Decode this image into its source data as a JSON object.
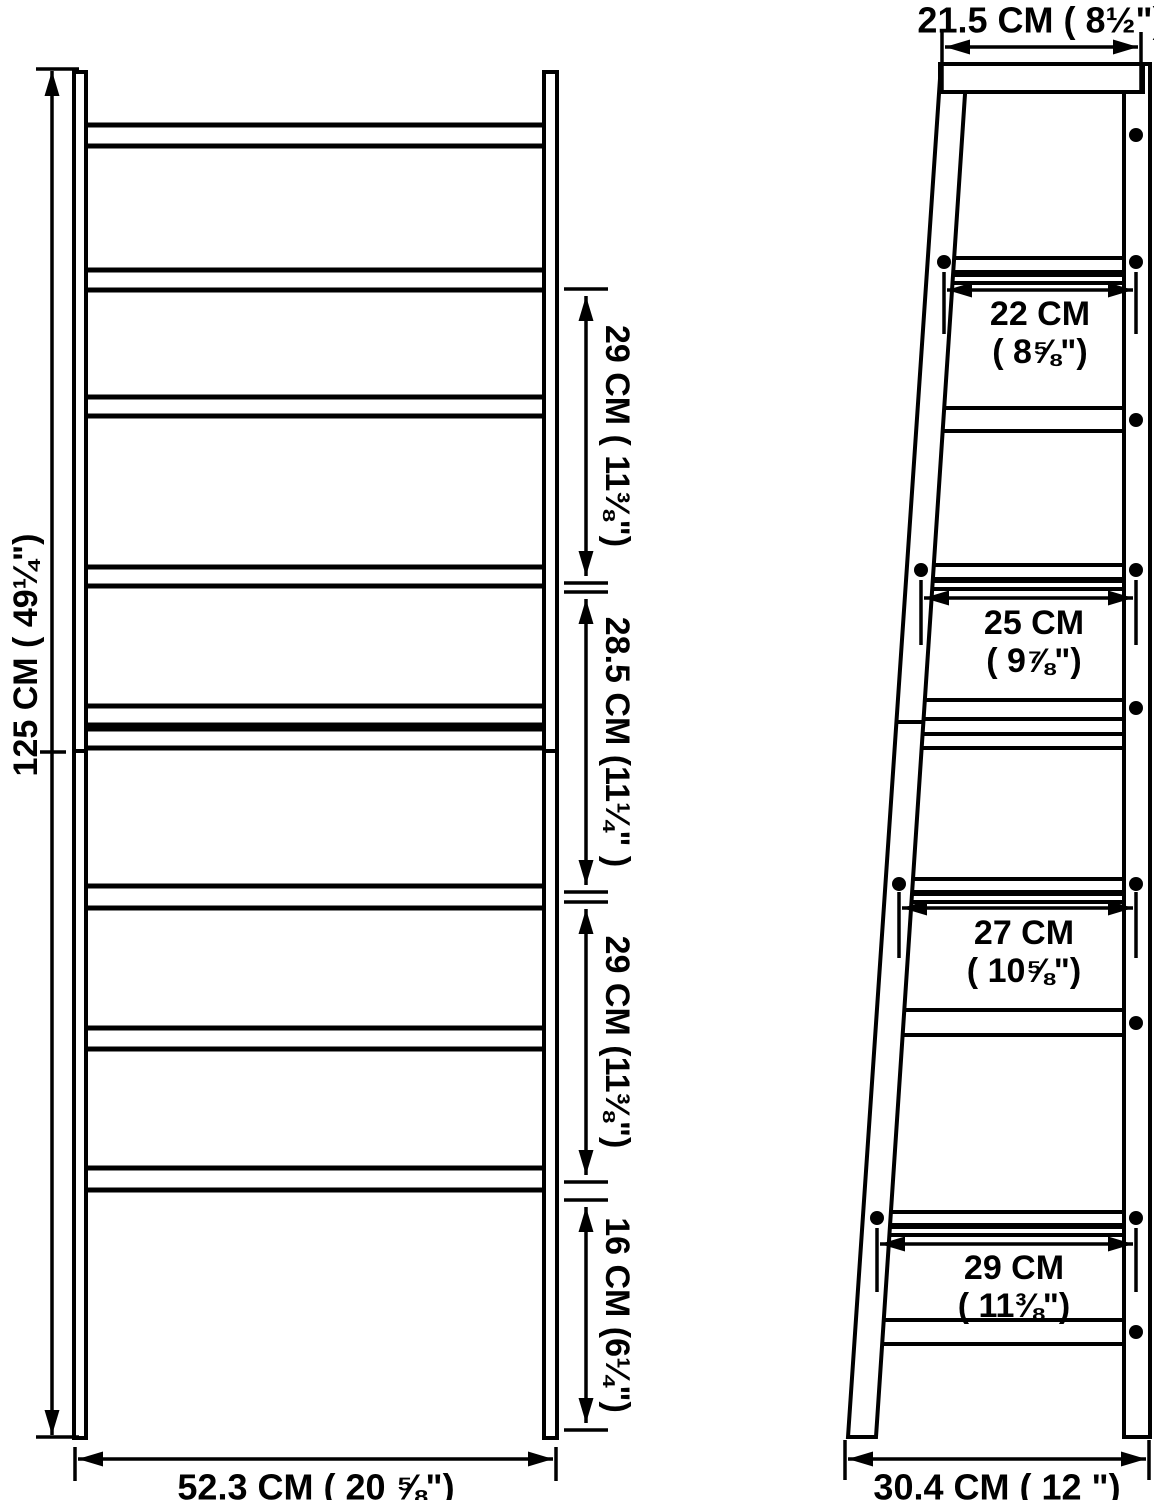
{
  "front_view": {
    "height_label": "125 CM ( 49¼\")",
    "width_label": "52.3 CM ( 20 ⅝\")",
    "tier_gaps": [
      {
        "label": "29 CM ( 11⅜\")"
      },
      {
        "label": "28.5 CM (11¼\" )"
      },
      {
        "label": "29 CM (11⅜\")"
      },
      {
        "label": "16 CM (6¼\")"
      }
    ]
  },
  "side_view": {
    "top_depth_label": "21.5 CM ( 8½\")",
    "base_depth_label": "30.4 CM ( 12 \")",
    "shelf_depths": [
      {
        "cm": "22 CM",
        "inch": "( 8⅝\")"
      },
      {
        "cm": "25 CM",
        "inch": "( 9⅞\")"
      },
      {
        "cm": "27 CM",
        "inch": "( 10⅝\")"
      },
      {
        "cm": "29 CM",
        "inch": "( 11⅜\")"
      }
    ]
  },
  "colors": {
    "line": "#000000",
    "background": "#ffffff"
  }
}
